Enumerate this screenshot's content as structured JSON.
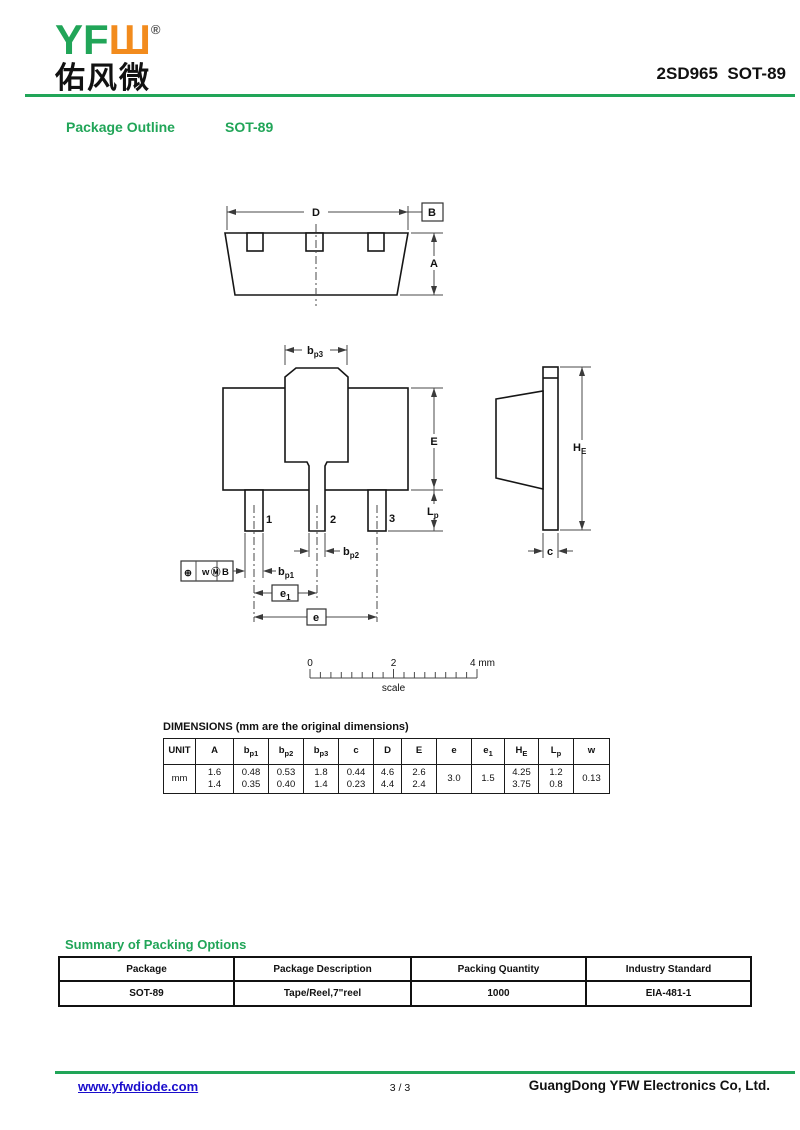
{
  "header": {
    "logo_text": "YFШ",
    "logo_reg": "®",
    "logo_cn": "佑风微",
    "part_number": "2SD965  SOT-89"
  },
  "section": {
    "title": "Package Outline",
    "subtitle": "SOT-89"
  },
  "drawing": {
    "labels": {
      "d": "D",
      "b_ref": "B",
      "a": "A",
      "bp3": {
        "m": "b",
        "s": "p3"
      },
      "e_body": "E",
      "lp": {
        "m": "L",
        "s": "p"
      },
      "he": {
        "m": "H",
        "s": "E"
      },
      "c": "c",
      "bp1": {
        "m": "b",
        "s": "p1"
      },
      "bp2": {
        "m": "b",
        "s": "p2"
      },
      "e1": {
        "m": "e",
        "s": "1"
      },
      "e": "e",
      "pin1": "1",
      "pin2": "2",
      "pin3": "3",
      "fcf": {
        "position": "⊕",
        "tol": "w",
        "modifier": "Ⓜ",
        "datum": "B"
      }
    },
    "scale": {
      "t0": "0",
      "t2": "2",
      "t4": "4 mm",
      "caption": "scale"
    }
  },
  "dims": {
    "title": "DIMENSIONS (mm are the original dimensions)",
    "unit": "mm",
    "cols": [
      {
        "m": "UNIT"
      },
      {
        "m": "A"
      },
      {
        "m": "b",
        "s": "p1"
      },
      {
        "m": "b",
        "s": "p2"
      },
      {
        "m": "b",
        "s": "p3"
      },
      {
        "m": "c"
      },
      {
        "m": "D"
      },
      {
        "m": "E"
      },
      {
        "m": "e"
      },
      {
        "m": "e",
        "s": "1"
      },
      {
        "m": "H",
        "s": "E"
      },
      {
        "m": "L",
        "s": "p"
      },
      {
        "m": "w"
      }
    ],
    "cells": [
      {
        "l1": "1.6",
        "l2": "1.4"
      },
      {
        "l1": "0.48",
        "l2": "0.35"
      },
      {
        "l1": "0.53",
        "l2": "0.40"
      },
      {
        "l1": "1.8",
        "l2": "1.4"
      },
      {
        "l1": "0.44",
        "l2": "0.23"
      },
      {
        "l1": "4.6",
        "l2": "4.4"
      },
      {
        "l1": "2.6",
        "l2": "2.4"
      },
      {
        "l1": "3.0",
        "l2": ""
      },
      {
        "l1": "1.5",
        "l2": ""
      },
      {
        "l1": "4.25",
        "l2": "3.75"
      },
      {
        "l1": "1.2",
        "l2": "0.8"
      },
      {
        "l1": "0.13",
        "l2": ""
      }
    ]
  },
  "packing": {
    "title": "Summary of Packing Options",
    "headers": [
      "Package",
      "Package Description",
      "Packing Quantity",
      "Industry Standard"
    ],
    "row": [
      "SOT-89",
      "Tape/Reel,7\"reel",
      "1000",
      "EIA-481-1"
    ]
  },
  "footer": {
    "website": "www.yfwdiode.com",
    "page": "3 / 3",
    "company": "GuangDong YFW Electronics Co, Ltd."
  }
}
